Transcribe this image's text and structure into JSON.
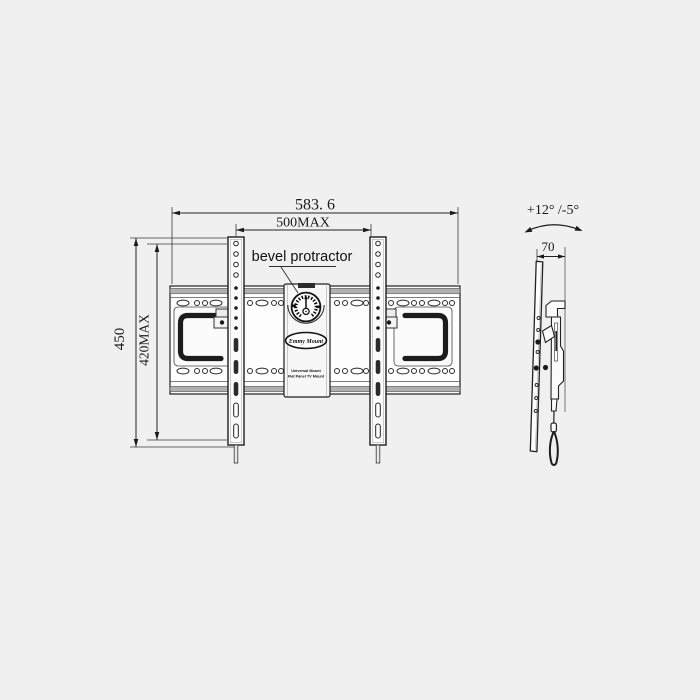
{
  "colors": {
    "background": "#f0f0f1",
    "line": "#222222",
    "metal_band": "#b0b0b0"
  },
  "front_view": {
    "callout": {
      "bevel_protractor": "bevel protractor"
    },
    "dimensions": {
      "overall_width": "583. 6",
      "max_hole_width": "500MAX",
      "overall_height": "450",
      "max_hole_height": "420MAX"
    },
    "logo": {
      "brand": "Emmy Mount",
      "tagline_line1": "Universal Mount",
      "tagline_line2": "Flat Panel TV Mount"
    }
  },
  "side_view": {
    "tilt_range": "+12° /-5°",
    "depth": "70"
  }
}
